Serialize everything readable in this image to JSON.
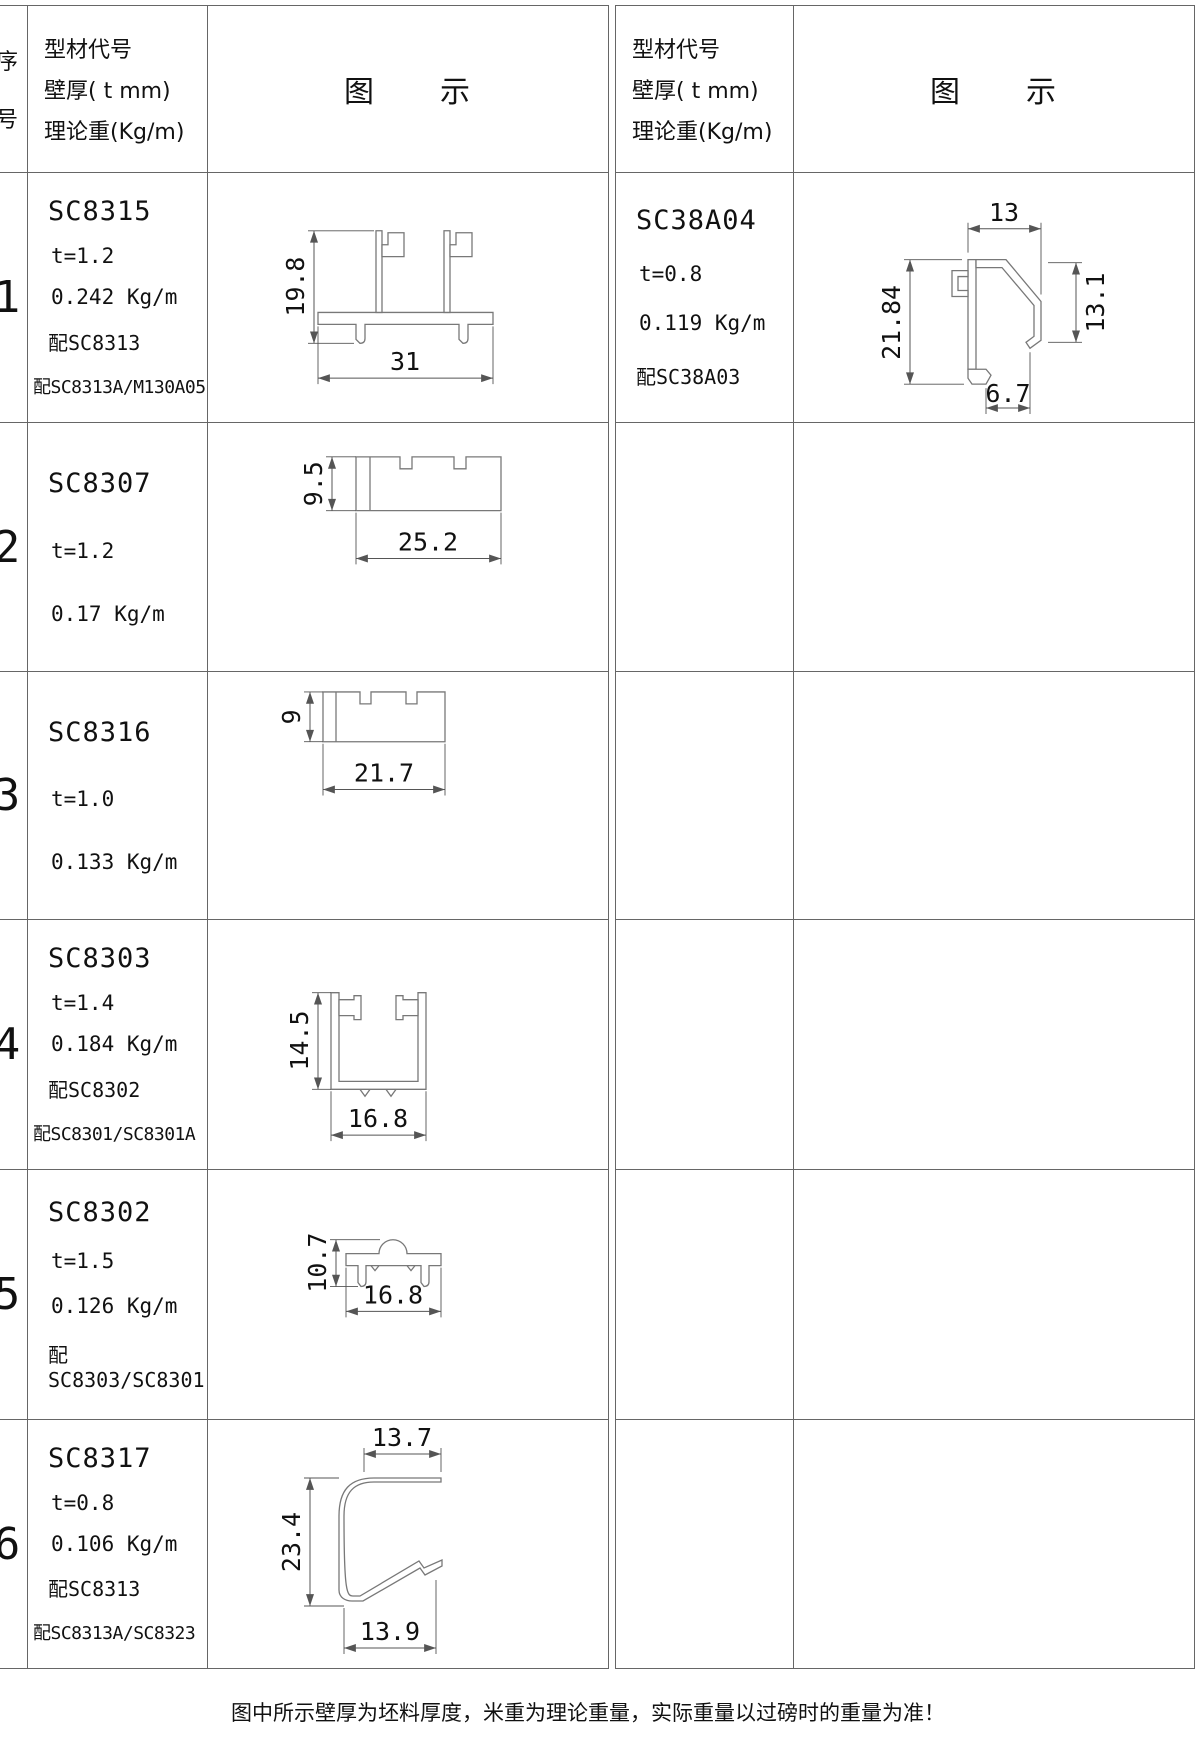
{
  "header": {
    "serial_top": "序",
    "serial_bottom": "号",
    "spec_line1": "型材代号",
    "spec_line2": "壁厚( t mm)",
    "spec_line3": "理论重(Kg/m)",
    "diagram": "图　　示"
  },
  "left_rows": [
    {
      "no": "1",
      "code": "SC8315",
      "thickness": "t=1.2",
      "weight": "0.242 Kg/m",
      "match1": "配SC8313",
      "match2": "配SC8313A/M130A05",
      "dim_h": "19.8",
      "dim_w": "31"
    },
    {
      "no": "2",
      "code": "SC8307",
      "thickness": "t=1.2",
      "weight": "0.17 Kg/m",
      "dim_h": "9.5",
      "dim_w": "25.2"
    },
    {
      "no": "3",
      "code": "SC8316",
      "thickness": "t=1.0",
      "weight": "0.133 Kg/m",
      "dim_h": "9",
      "dim_w": "21.7"
    },
    {
      "no": "4",
      "code": "SC8303",
      "thickness": "t=1.4",
      "weight": "0.184 Kg/m",
      "match1": "配SC8302",
      "match2": "配SC8301/SC8301A",
      "dim_h": "14.5",
      "dim_w": "16.8"
    },
    {
      "no": "5",
      "code": "SC8302",
      "thickness": "t=1.5",
      "weight": "0.126 Kg/m",
      "match1": "配SC8303/SC8301",
      "dim_h": "10.7",
      "dim_w": "16.8"
    },
    {
      "no": "6",
      "code": "SC8317",
      "thickness": "t=0.8",
      "weight": "0.106 Kg/m",
      "match1": "配SC8313",
      "match2": "配SC8313A/SC8323",
      "dim_top": "13.7",
      "dim_h": "23.4",
      "dim_bottom": "13.9"
    }
  ],
  "right_rows": [
    {
      "code": "SC38A04",
      "thickness": "t=0.8",
      "weight": "0.119 Kg/m",
      "match1": "配SC38A03",
      "dim_top": "13",
      "dim_h": "21.84",
      "dim_right": "13.1",
      "dim_bottom": "6.7"
    }
  ],
  "footer_note": "图中所示壁厚为坯料厚度，米重为理论重量，实际重量以过磅时的重量为准！"
}
